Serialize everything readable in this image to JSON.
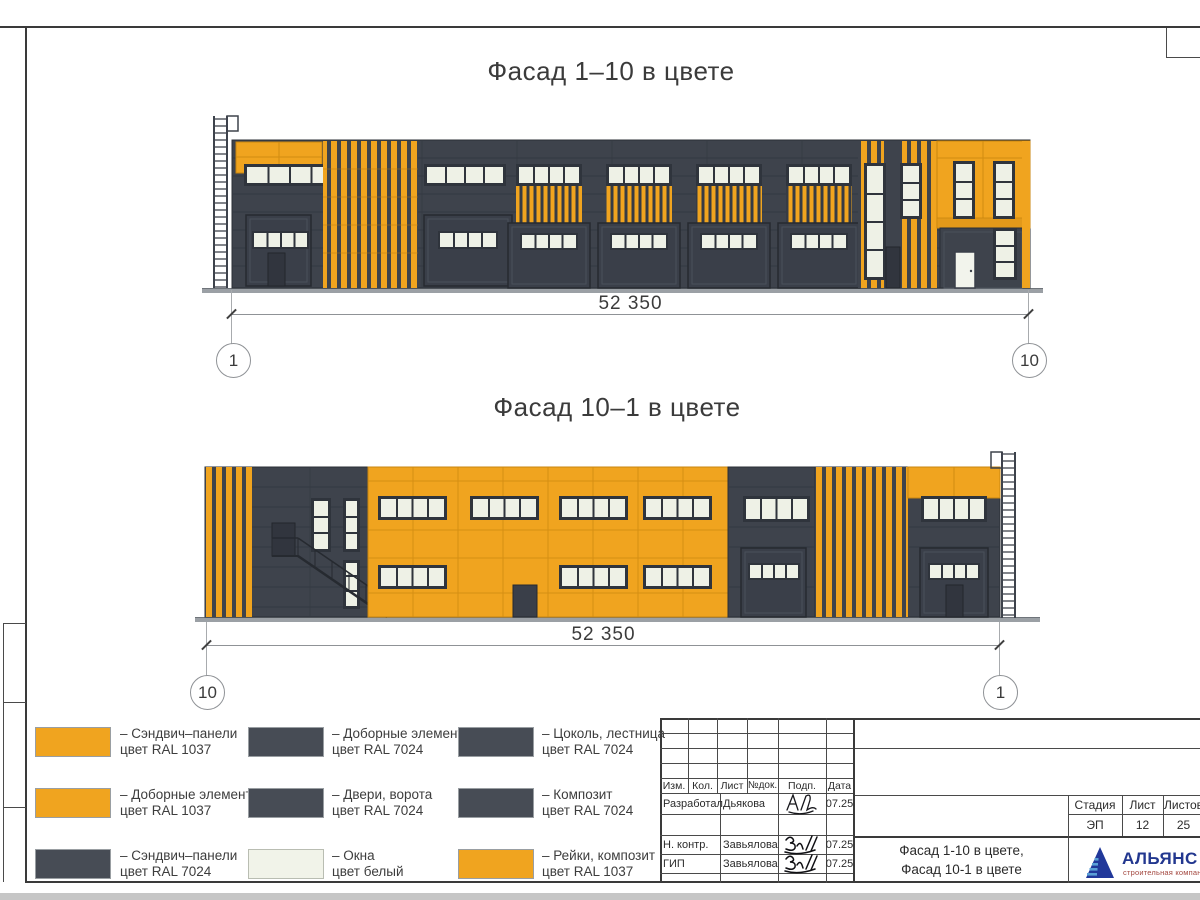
{
  "sheet": {
    "facade1": {
      "title": "Фасад 1–10 в цвете",
      "dimension": "52 350",
      "axis_left": "1",
      "axis_right": "10"
    },
    "facade2": {
      "title": "Фасад 10–1 в цвете",
      "dimension": "52 350",
      "axis_left": "10",
      "axis_right": "1"
    }
  },
  "colors": {
    "ral1037_orange": "#F0A41F",
    "ral7024_dark": "#3E434C",
    "window_white": "#EEF1E6",
    "ground_gray": "#9BA0A5",
    "logo_blue": "#22378F",
    "logo_red": "#A3473F"
  },
  "legend": {
    "items": [
      {
        "color": "#F0A41F",
        "line1": "– Сэндвич–панели",
        "line2": "цвет RAL 1037"
      },
      {
        "color": "#F0A41F",
        "line1": "– Доборные элементы",
        "line2": "цвет RAL 1037"
      },
      {
        "color": "#474C55",
        "line1": "– Сэндвич–панели",
        "line2": "цвет RAL 7024"
      },
      {
        "color": "#474C55",
        "line1": "– Доборные элементы",
        "line2": "цвет RAL 7024"
      },
      {
        "color": "#474C55",
        "line1": "– Двери, ворота",
        "line2": "цвет RAL 7024"
      },
      {
        "color": "#F1F3E9",
        "line1": "– Окна",
        "line2": "цвет белый"
      },
      {
        "color": "#474C55",
        "line1": "– Цоколь, лестница",
        "line2": "цвет RAL 7024"
      },
      {
        "color": "#474C55",
        "line1": "– Композит",
        "line2": "цвет RAL 7024"
      },
      {
        "color": "#F0A41F",
        "line1": "– Рейки, композит",
        "line2": "цвет RAL 1037"
      }
    ]
  },
  "stamp": {
    "cols": {
      "izm": "Изм.",
      "kol": "Кол.",
      "list": "Лист",
      "ndok": "№док.",
      "podp": "Подп.",
      "data": "Дата"
    },
    "rows": [
      {
        "role": "Разработал",
        "name": "Дьякова",
        "date": "07.25"
      },
      {
        "role": "Н. контр.",
        "name": "Завьялова",
        "date": "07.25"
      },
      {
        "role": "ГИП",
        "name": "Завьялова",
        "date": "07.25"
      }
    ],
    "stage_label": "Стадия",
    "sheet_label": "Лист",
    "sheets_label": "Листов",
    "stage": "ЭП",
    "sheet_num": "12",
    "sheets_num": "25",
    "doc_title1": "Фасад 1-10 в цвете,",
    "doc_title2": "Фасад 10-1 в цвете",
    "logo": {
      "name": "АЛЬЯНС",
      "sub": "строительная компания"
    }
  }
}
